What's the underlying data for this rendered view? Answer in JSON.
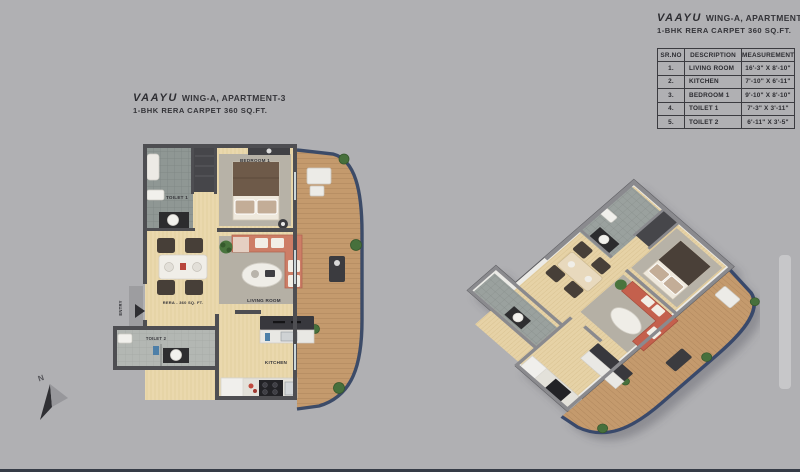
{
  "page": {
    "background": "#b0b0b3",
    "accent_navy": "#3c4b68",
    "bottom_bar_color": "#353b46"
  },
  "left_plan": {
    "brand": "VAAYU",
    "title": "WING-A, APARTMENT-3",
    "subtitle": "1-BHK RERA CARPET 360 SQ.FT.",
    "rooms": {
      "bedroom": "BEDROOM 1",
      "toilet1": "TOILET 1",
      "toilet2": "TOILET 2",
      "living_room": "LIVING ROOM",
      "kitchen": "KITCHEN"
    },
    "area_label": "RERA - 360 SQ. FT.",
    "entry_label": "ENTRY",
    "compass_label": "N"
  },
  "spec_panel": {
    "brand": "VAAYU",
    "title": "WING-A, APARTMENT-3",
    "subtitle": "1-BHK RERA CARPET 360 SQ.FT.",
    "table": {
      "headers": [
        "SR.NO",
        "DESCRIPTION",
        "MEASUREMENT"
      ],
      "rows": [
        {
          "no": "1.",
          "desc": "LIVING ROOM",
          "size": "16'-3\" X 8'-10\""
        },
        {
          "no": "2.",
          "desc": "KITCHEN",
          "size": "7'-10\" X 6'-11\""
        },
        {
          "no": "3.",
          "desc": "BEDROOM 1",
          "size": "9'-10\" X 8'-10\""
        },
        {
          "no": "4.",
          "desc": "TOILET 1",
          "size": "7'-3\" X 3'-11\""
        },
        {
          "no": "5.",
          "desc": "TOILET 2",
          "size": "6'-11\" X 3'-5\""
        }
      ]
    }
  }
}
